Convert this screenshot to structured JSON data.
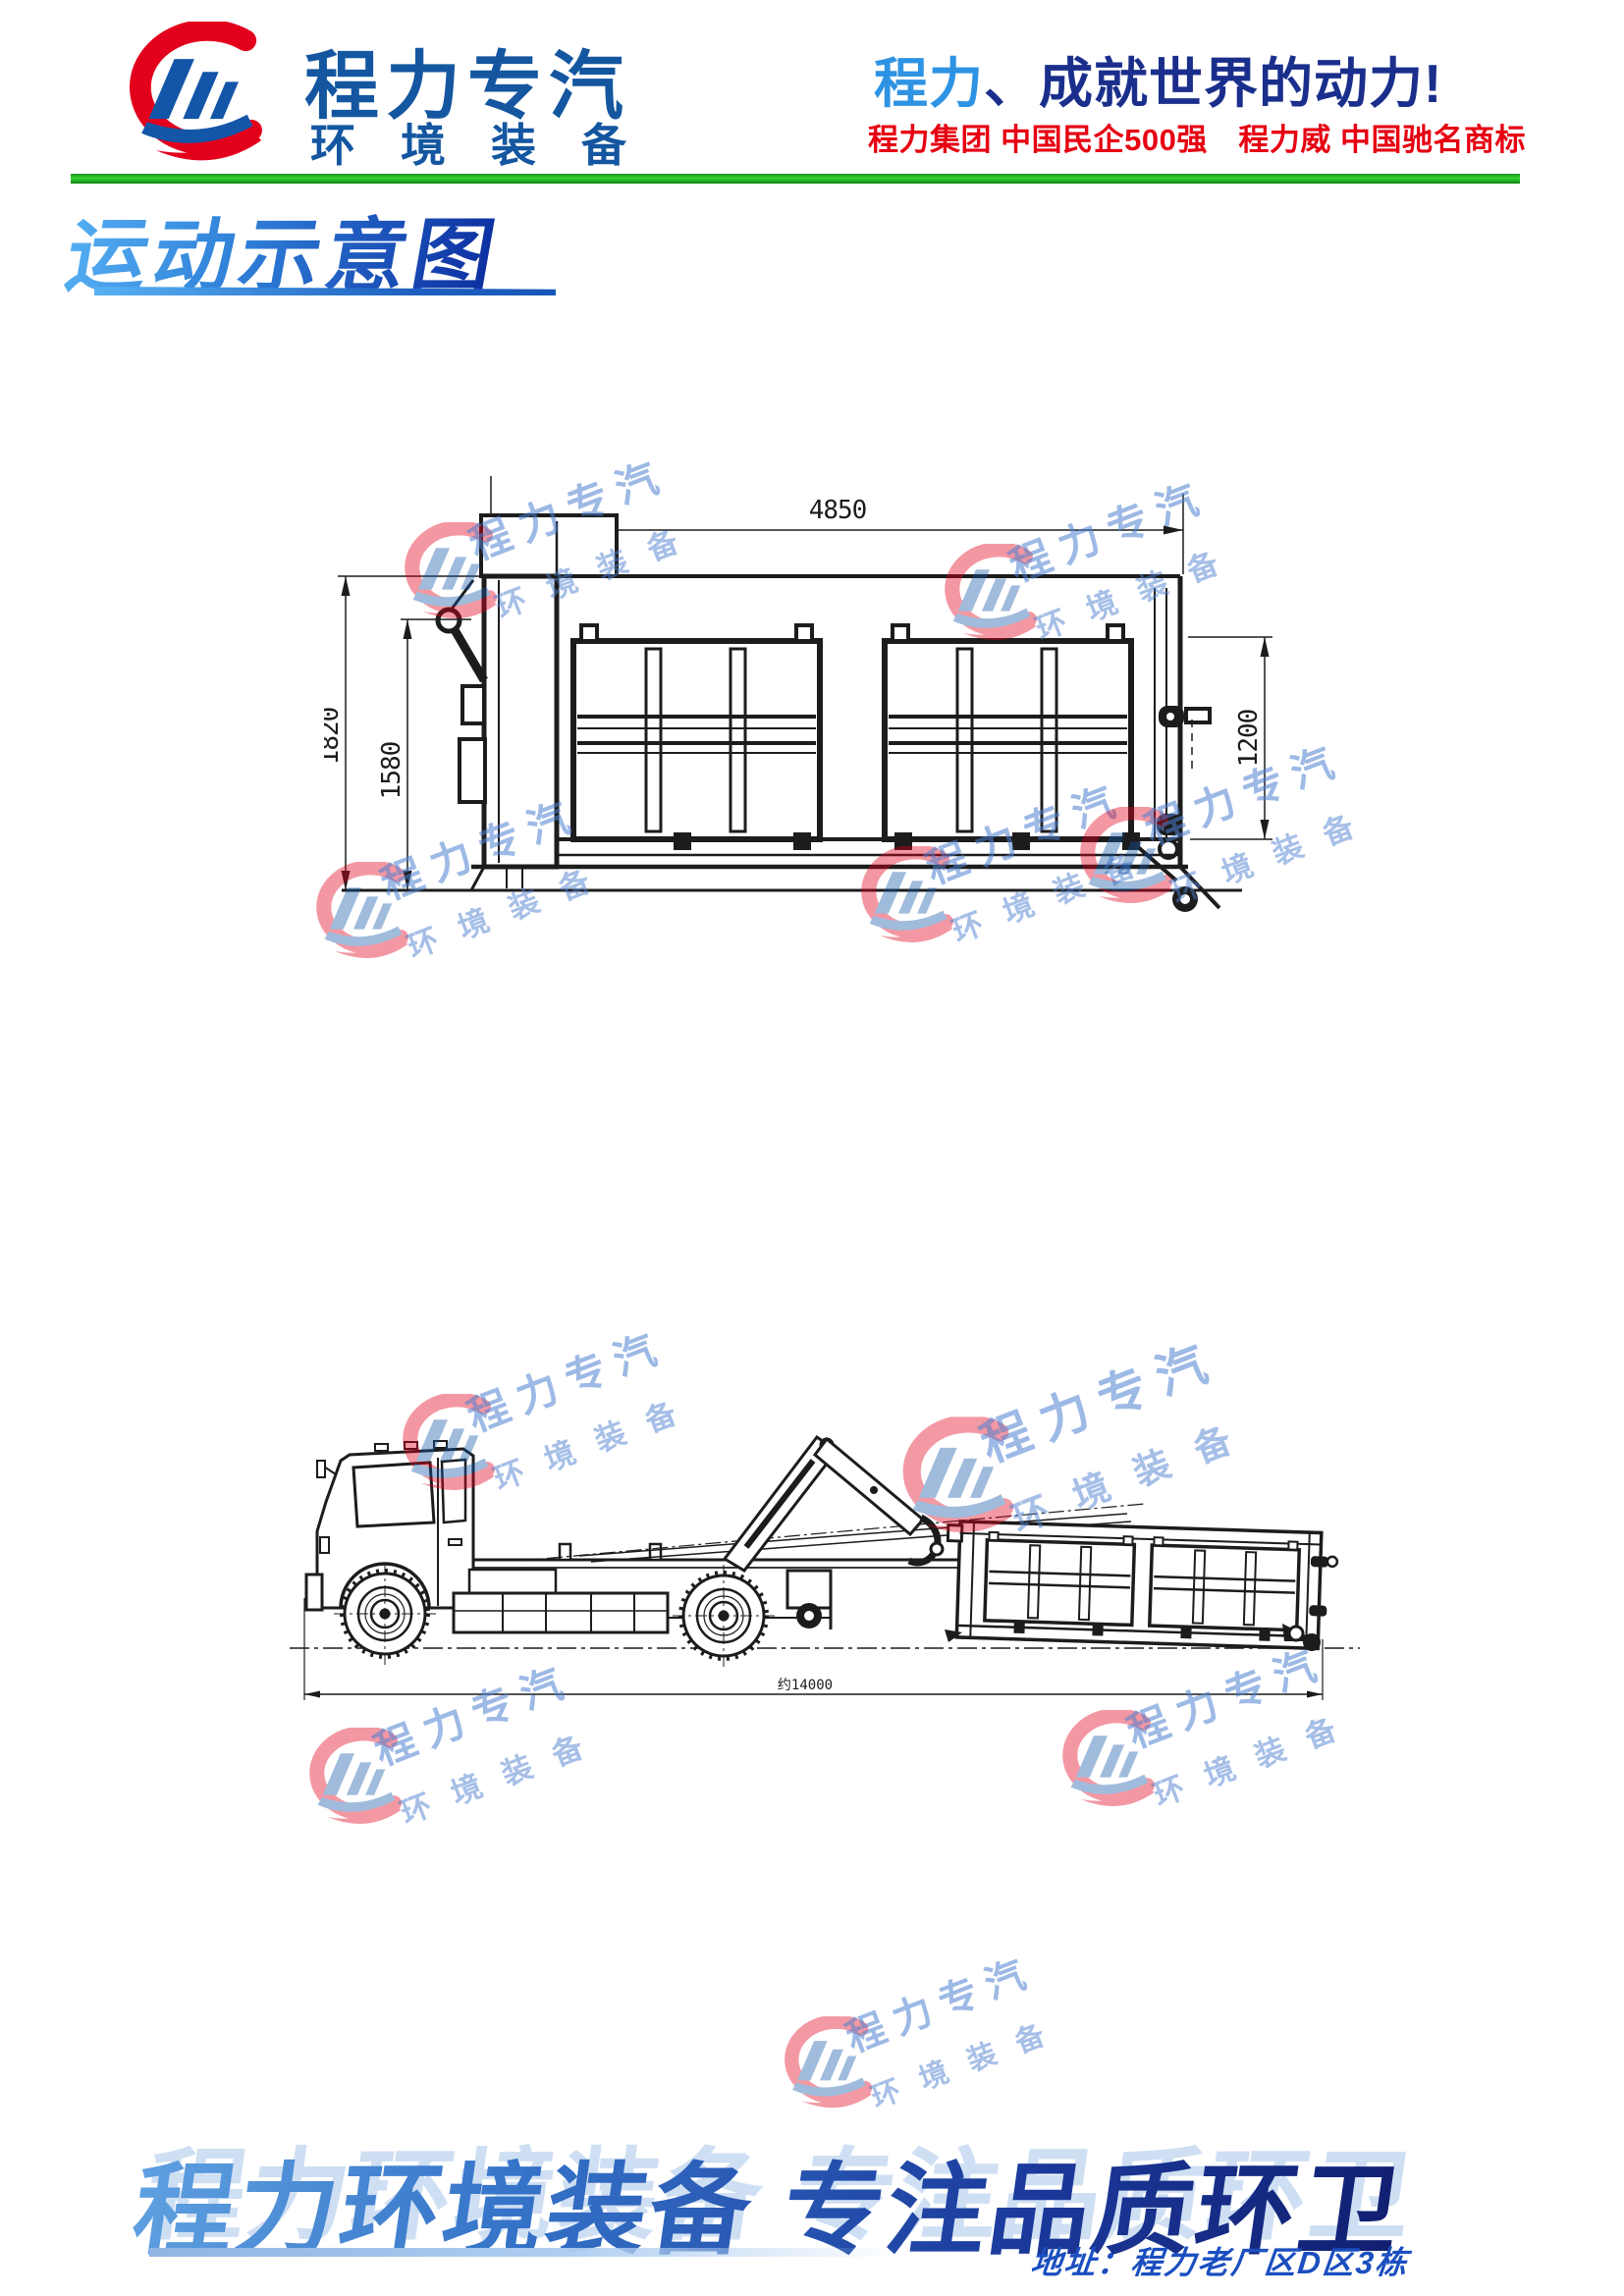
{
  "header": {
    "brand_name": "程力专汽",
    "brand_sub": "环境装备",
    "slogan_highlight": "程力",
    "slogan_rest": "、成就世界的动力!",
    "honors": "程力集团 中国民企500强　程力威 中国驰名商标"
  },
  "section": {
    "title": "运动示意图"
  },
  "watermark": {
    "line1": "程力专汽",
    "line2": "环境装备"
  },
  "drawings": {
    "container_side_view": {
      "dim_width_top": "4850",
      "dim_height_outer": "1820",
      "dim_height_inner": "1580",
      "dim_height_rear": "1200"
    },
    "truck_unloading_view": {
      "dim_overall_length": "约14000"
    }
  },
  "footer": {
    "banner": "程力环境装备 专注品质环卫",
    "address_label": "地址：",
    "address_value": "程力老厂区D区3栋"
  },
  "colors": {
    "brand_red": "#e2001c",
    "brand_blue": "#1456a0",
    "slogan_light_blue": "#2e93e3",
    "slogan_dark_blue": "#1a2f8c",
    "accent_green": "#22b422",
    "watermark_blue": "#4d80d0",
    "line_black": "#1c1c1c"
  }
}
